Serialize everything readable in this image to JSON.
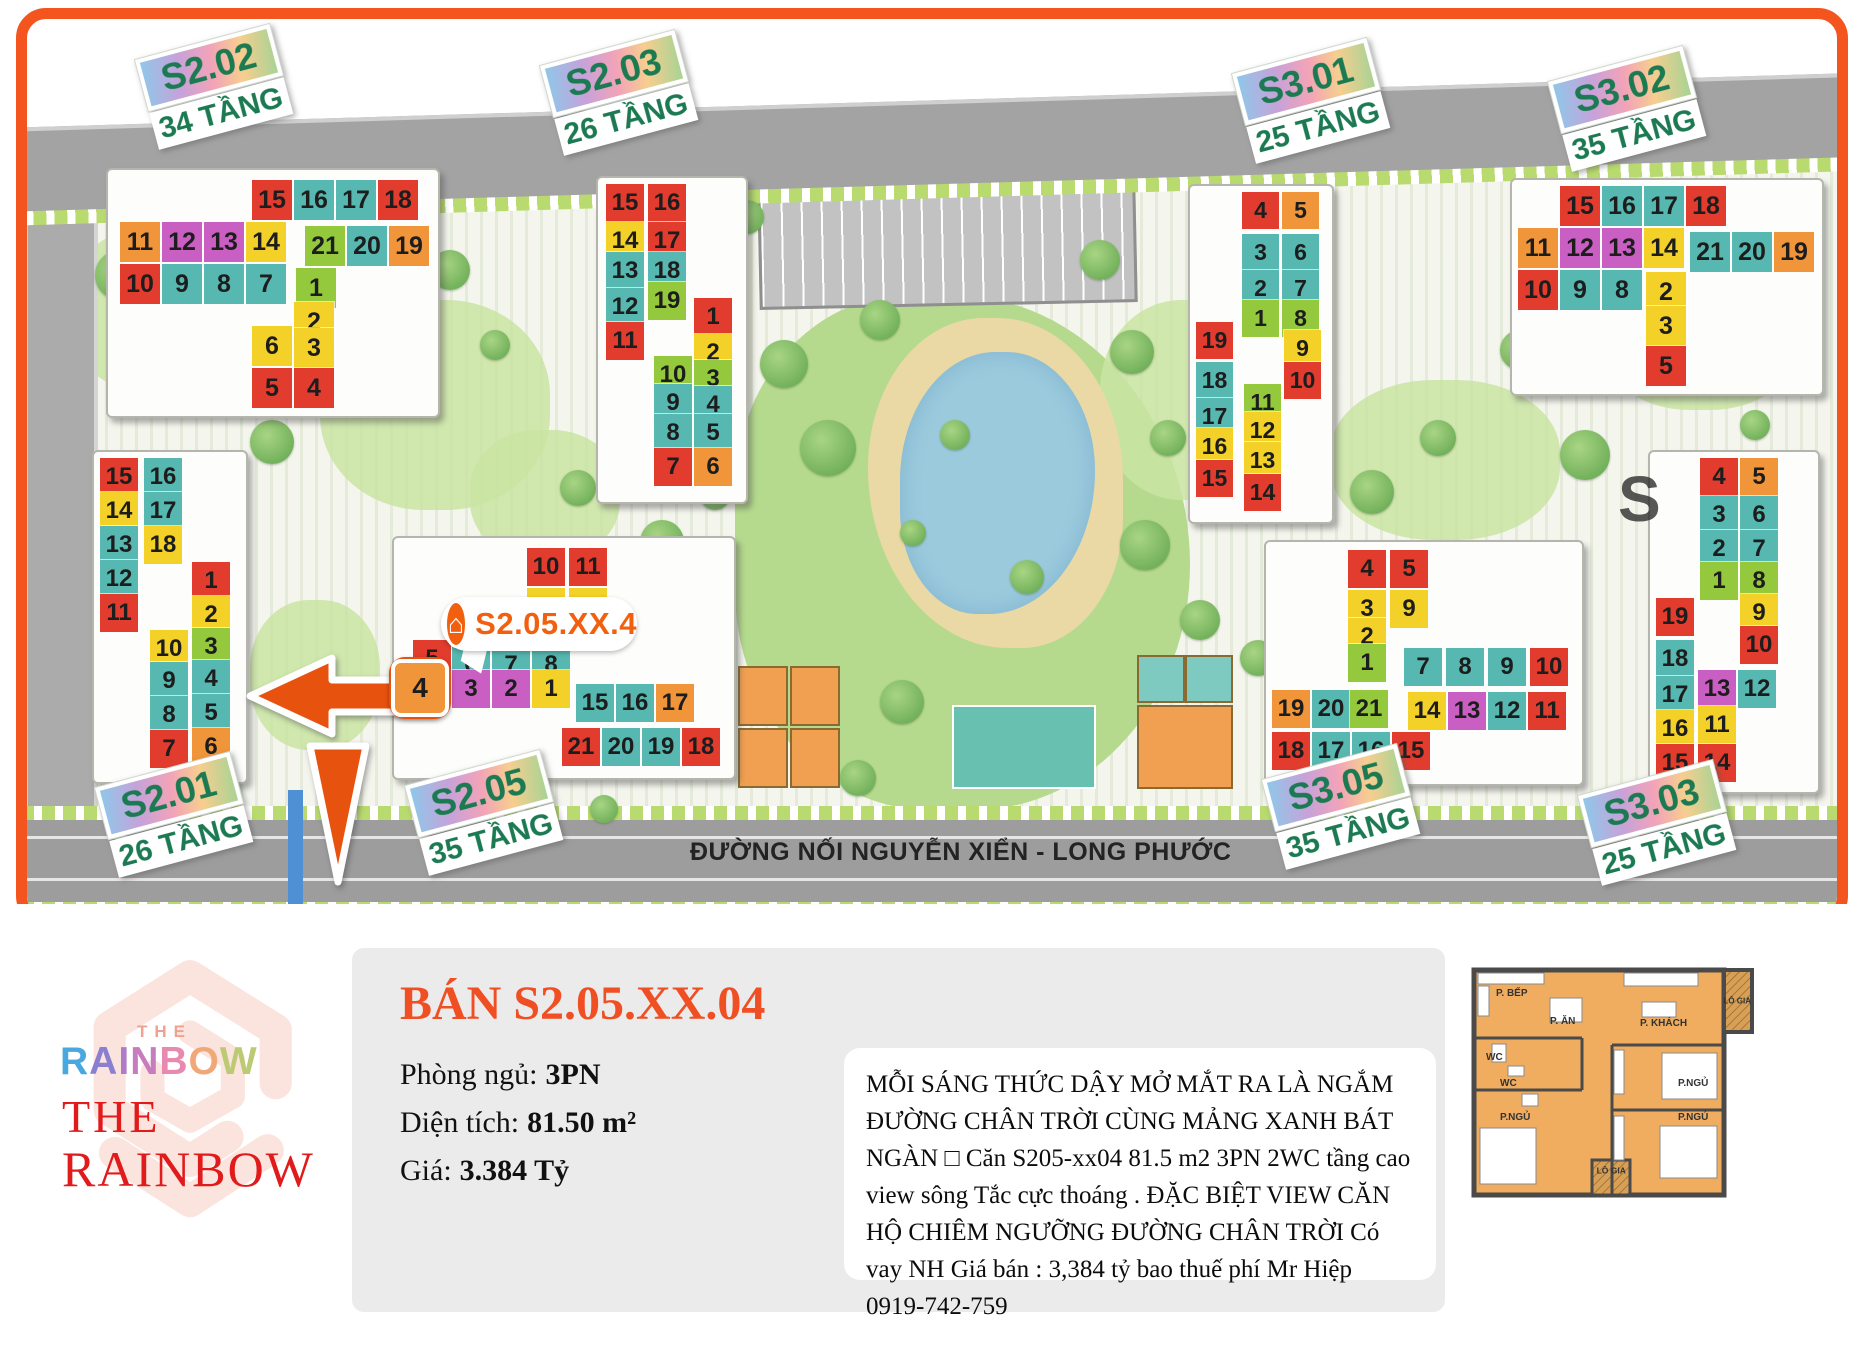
{
  "map": {
    "road_label": "ĐƯỜNG NỐI NGUYỄN XIỂN - LONG PHƯỚC",
    "annotation": {
      "label": "S2.05.XX.4",
      "icon": "house-icon"
    },
    "highlight_unit": "4",
    "watermark_letter": "S",
    "palette": {
      "red": "#e23c2e",
      "teal": "#56b8b0",
      "yellow": "#f3d128",
      "orange": "#f0953a",
      "magenta": "#c95fc2",
      "green": "#95c93d"
    },
    "badges": [
      {
        "code": "S2.02",
        "floors": "34 TẦNG",
        "x": 135,
        "y": 60
      },
      {
        "code": "S2.03",
        "floors": "26 TẦNG",
        "x": 540,
        "y": 66
      },
      {
        "code": "S3.01",
        "floors": "25 TẦNG",
        "x": 1232,
        "y": 74
      },
      {
        "code": "S3.02",
        "floors": "35 TẦNG",
        "x": 1548,
        "y": 82
      },
      {
        "code": "S2.01",
        "floors": "26 TẦNG",
        "x": 95,
        "y": 788
      },
      {
        "code": "S2.05",
        "floors": "35 TẦNG",
        "x": 405,
        "y": 786
      },
      {
        "code": "S3.05",
        "floors": "35 TẦNG",
        "x": 1262,
        "y": 780
      },
      {
        "code": "S3.03",
        "floors": "25 TẦNG",
        "x": 1578,
        "y": 796
      }
    ],
    "buildings": [
      {
        "id": "S2.02",
        "slab": [
          106,
          168,
          330,
          246
        ],
        "tile": 40,
        "cells": [
          [
            15,
            "red",
            252,
            180
          ],
          [
            16,
            "teal",
            294,
            180
          ],
          [
            17,
            "teal",
            336,
            180
          ],
          [
            18,
            "red",
            378,
            180
          ],
          [
            11,
            "orange",
            120,
            222
          ],
          [
            12,
            "magenta",
            162,
            222
          ],
          [
            13,
            "magenta",
            204,
            222
          ],
          [
            14,
            "yellow",
            246,
            222
          ],
          [
            21,
            "green",
            305,
            226
          ],
          [
            20,
            "teal",
            347,
            226
          ],
          [
            19,
            "orange",
            389,
            226
          ],
          [
            10,
            "red",
            120,
            264
          ],
          [
            9,
            "teal",
            162,
            264
          ],
          [
            8,
            "teal",
            204,
            264
          ],
          [
            7,
            "teal",
            246,
            264
          ],
          [
            1,
            "green",
            296,
            268
          ],
          [
            2,
            "yellow",
            294,
            302
          ],
          [
            6,
            "yellow",
            252,
            326
          ],
          [
            3,
            "yellow",
            294,
            328
          ],
          [
            5,
            "red",
            252,
            368
          ],
          [
            4,
            "red",
            294,
            368
          ]
        ]
      },
      {
        "id": "S2.03",
        "slab": [
          596,
          176,
          148,
          324
        ],
        "tile": 38,
        "cells": [
          [
            15,
            "red",
            606,
            184
          ],
          [
            16,
            "red",
            648,
            184
          ],
          [
            14,
            "yellow",
            606,
            222
          ],
          [
            17,
            "red",
            648,
            222
          ],
          [
            13,
            "teal",
            606,
            252
          ],
          [
            18,
            "teal",
            648,
            252
          ],
          [
            12,
            "teal",
            606,
            288
          ],
          [
            19,
            "green",
            648,
            282
          ],
          [
            11,
            "red",
            606,
            322
          ],
          [
            1,
            "red",
            694,
            298
          ],
          [
            2,
            "yellow",
            694,
            334
          ],
          [
            10,
            "green",
            654,
            356
          ],
          [
            3,
            "green",
            694,
            360
          ],
          [
            9,
            "teal",
            654,
            384
          ],
          [
            4,
            "teal",
            694,
            386
          ],
          [
            8,
            "teal",
            654,
            414
          ],
          [
            5,
            "teal",
            694,
            414
          ],
          [
            7,
            "red",
            654,
            448
          ],
          [
            6,
            "orange",
            694,
            448
          ]
        ]
      },
      {
        "id": "S2.01",
        "slab": [
          92,
          450,
          152,
          330
        ],
        "tile": 38,
        "cells": [
          [
            15,
            "red",
            100,
            458
          ],
          [
            16,
            "teal",
            144,
            458
          ],
          [
            14,
            "yellow",
            100,
            492
          ],
          [
            17,
            "teal",
            144,
            492
          ],
          [
            13,
            "teal",
            100,
            526
          ],
          [
            18,
            "yellow",
            144,
            526
          ],
          [
            12,
            "teal",
            100,
            560
          ],
          [
            11,
            "red",
            100,
            594
          ],
          [
            1,
            "red",
            192,
            562
          ],
          [
            2,
            "yellow",
            192,
            596
          ],
          [
            3,
            "green",
            192,
            628
          ],
          [
            10,
            "yellow",
            150,
            630
          ],
          [
            9,
            "teal",
            150,
            662
          ],
          [
            4,
            "teal",
            192,
            660
          ],
          [
            8,
            "teal",
            150,
            696
          ],
          [
            5,
            "teal",
            192,
            694
          ],
          [
            7,
            "red",
            150,
            730
          ],
          [
            6,
            "orange",
            192,
            728
          ]
        ]
      },
      {
        "id": "S2.05",
        "slab": [
          392,
          536,
          340,
          240
        ],
        "tile": 38,
        "cells": [
          [
            10,
            "red",
            527,
            548
          ],
          [
            11,
            "red",
            569,
            548
          ],
          [
            9,
            "yellow",
            527,
            588
          ],
          [
            12,
            "yellow",
            569,
            588
          ],
          [
            5,
            "red",
            413,
            640
          ],
          [
            6,
            "teal",
            452,
            646
          ],
          [
            7,
            "teal",
            492,
            646
          ],
          [
            8,
            "teal",
            532,
            646
          ],
          [
            3,
            "magenta",
            452,
            670
          ],
          [
            2,
            "magenta",
            492,
            670
          ],
          [
            1,
            "yellow",
            532,
            670
          ],
          [
            15,
            "teal",
            576,
            684
          ],
          [
            16,
            "teal",
            616,
            684
          ],
          [
            17,
            "orange",
            656,
            684
          ],
          [
            21,
            "red",
            562,
            728
          ],
          [
            20,
            "teal",
            602,
            728
          ],
          [
            19,
            "teal",
            642,
            728
          ],
          [
            18,
            "red",
            682,
            728
          ]
        ]
      },
      {
        "id": "S3.01",
        "slab": [
          1188,
          184,
          142,
          336
        ],
        "tile": 37,
        "cells": [
          [
            4,
            "red",
            1242,
            192
          ],
          [
            5,
            "orange",
            1282,
            192
          ],
          [
            3,
            "teal",
            1242,
            234
          ],
          [
            6,
            "teal",
            1282,
            234
          ],
          [
            2,
            "teal",
            1242,
            270
          ],
          [
            7,
            "teal",
            1282,
            270
          ],
          [
            1,
            "green",
            1242,
            300
          ],
          [
            8,
            "green",
            1282,
            300
          ],
          [
            9,
            "yellow",
            1284,
            330
          ],
          [
            10,
            "red",
            1284,
            362
          ],
          [
            19,
            "red",
            1196,
            322
          ],
          [
            18,
            "teal",
            1196,
            362
          ],
          [
            17,
            "teal",
            1196,
            398
          ],
          [
            16,
            "yellow",
            1196,
            428
          ],
          [
            15,
            "red",
            1196,
            460
          ],
          [
            11,
            "green",
            1244,
            384
          ],
          [
            12,
            "yellow",
            1244,
            412
          ],
          [
            13,
            "yellow",
            1244,
            442
          ],
          [
            14,
            "red",
            1244,
            474
          ]
        ]
      },
      {
        "id": "S3.02",
        "slab": [
          1510,
          178,
          310,
          214
        ],
        "tile": 40,
        "cells": [
          [
            15,
            "red",
            1560,
            186
          ],
          [
            16,
            "teal",
            1602,
            186
          ],
          [
            17,
            "teal",
            1644,
            186
          ],
          [
            18,
            "red",
            1686,
            186
          ],
          [
            11,
            "orange",
            1518,
            228
          ],
          [
            12,
            "magenta",
            1560,
            228
          ],
          [
            13,
            "magenta",
            1602,
            228
          ],
          [
            14,
            "yellow",
            1644,
            228
          ],
          [
            21,
            "teal",
            1690,
            232
          ],
          [
            20,
            "teal",
            1732,
            232
          ],
          [
            19,
            "orange",
            1774,
            232
          ],
          [
            10,
            "red",
            1518,
            270
          ],
          [
            9,
            "teal",
            1560,
            270
          ],
          [
            8,
            "teal",
            1602,
            270
          ],
          [
            2,
            "yellow",
            1646,
            272
          ],
          [
            3,
            "yellow",
            1646,
            306
          ],
          [
            5,
            "red",
            1646,
            346
          ]
        ]
      },
      {
        "id": "S3.05",
        "slab": [
          1264,
          540,
          316,
          242
        ],
        "tile": 38,
        "cells": [
          [
            4,
            "red",
            1348,
            550
          ],
          [
            5,
            "red",
            1390,
            550
          ],
          [
            3,
            "yellow",
            1348,
            590
          ],
          [
            9,
            "yellow",
            1390,
            590
          ],
          [
            2,
            "yellow",
            1348,
            618
          ],
          [
            1,
            "green",
            1348,
            644
          ],
          [
            7,
            "teal",
            1404,
            648
          ],
          [
            8,
            "teal",
            1446,
            648
          ],
          [
            9,
            "teal",
            1488,
            648
          ],
          [
            10,
            "red",
            1530,
            648
          ],
          [
            19,
            "orange",
            1272,
            690
          ],
          [
            20,
            "teal",
            1312,
            690
          ],
          [
            21,
            "green",
            1350,
            690
          ],
          [
            14,
            "yellow",
            1408,
            692
          ],
          [
            13,
            "magenta",
            1448,
            692
          ],
          [
            12,
            "teal",
            1488,
            692
          ],
          [
            11,
            "red",
            1528,
            692
          ],
          [
            18,
            "red",
            1272,
            732
          ],
          [
            17,
            "teal",
            1312,
            732
          ],
          [
            16,
            "teal",
            1352,
            732
          ],
          [
            15,
            "red",
            1392,
            732
          ]
        ]
      },
      {
        "id": "S3.03",
        "slab": [
          1648,
          450,
          168,
          340
        ],
        "tile": 38,
        "cells": [
          [
            4,
            "red",
            1700,
            458
          ],
          [
            5,
            "orange",
            1740,
            458
          ],
          [
            3,
            "teal",
            1700,
            496
          ],
          [
            6,
            "teal",
            1740,
            496
          ],
          [
            2,
            "teal",
            1700,
            530
          ],
          [
            7,
            "teal",
            1740,
            530
          ],
          [
            1,
            "green",
            1700,
            562
          ],
          [
            8,
            "green",
            1740,
            562
          ],
          [
            9,
            "yellow",
            1740,
            594
          ],
          [
            19,
            "red",
            1656,
            598
          ],
          [
            10,
            "red",
            1740,
            626
          ],
          [
            18,
            "teal",
            1656,
            640
          ],
          [
            17,
            "teal",
            1656,
            676
          ],
          [
            13,
            "magenta",
            1698,
            670
          ],
          [
            12,
            "teal",
            1738,
            670
          ],
          [
            16,
            "yellow",
            1656,
            710
          ],
          [
            11,
            "yellow",
            1698,
            706
          ],
          [
            15,
            "red",
            1656,
            744
          ],
          [
            14,
            "red",
            1698,
            744
          ]
        ]
      }
    ]
  },
  "footer": {
    "logo": {
      "the_small": "THE",
      "rainbow_colored": "RAINBOW",
      "letter_colors": [
        "#4aa8e0",
        "#8a7fd0",
        "#b07cc8",
        "#c87cc0",
        "#e88ab0",
        "#f0a878",
        "#bcca74"
      ],
      "the_red": "THE",
      "rainbow_red": "RAINBOW"
    },
    "panel": {
      "title": "BÁN S2.05.XX.04",
      "specs": [
        {
          "label": "Phòng ngủ:",
          "value": "3PN"
        },
        {
          "label": "Diện tích:",
          "value": "81.50 m²"
        },
        {
          "label": "Giá:",
          "value": "3.384 Tỷ"
        }
      ],
      "description": "MỖI SÁNG THỨC DẬY MỞ MẮT RA LÀ NGẮM ĐƯỜNG CHÂN TRỜI CÙNG MẢNG XANH BÁT NGÀN □ Căn S205-xx04 81.5 m2 3PN 2WC tầng cao view sông Tắc cực thoáng . ĐẶC BIỆT VIEW CĂN HỘ CHIÊM NGƯỠNG ĐƯỜNG CHÂN TRỜI Có vay NH Giá bán : 3,384 tỷ bao thuế phí Mr Hiệp 0919-742-759"
    },
    "floorplan": {
      "labels": [
        "P. BẾP",
        "P. ĂN",
        "P. KHÁCH",
        "LÔ GIA",
        "WC",
        "WC",
        "P.NGỦ",
        "P.NGỦ",
        "P.NGỦ",
        "LÔ GIA"
      ]
    }
  }
}
